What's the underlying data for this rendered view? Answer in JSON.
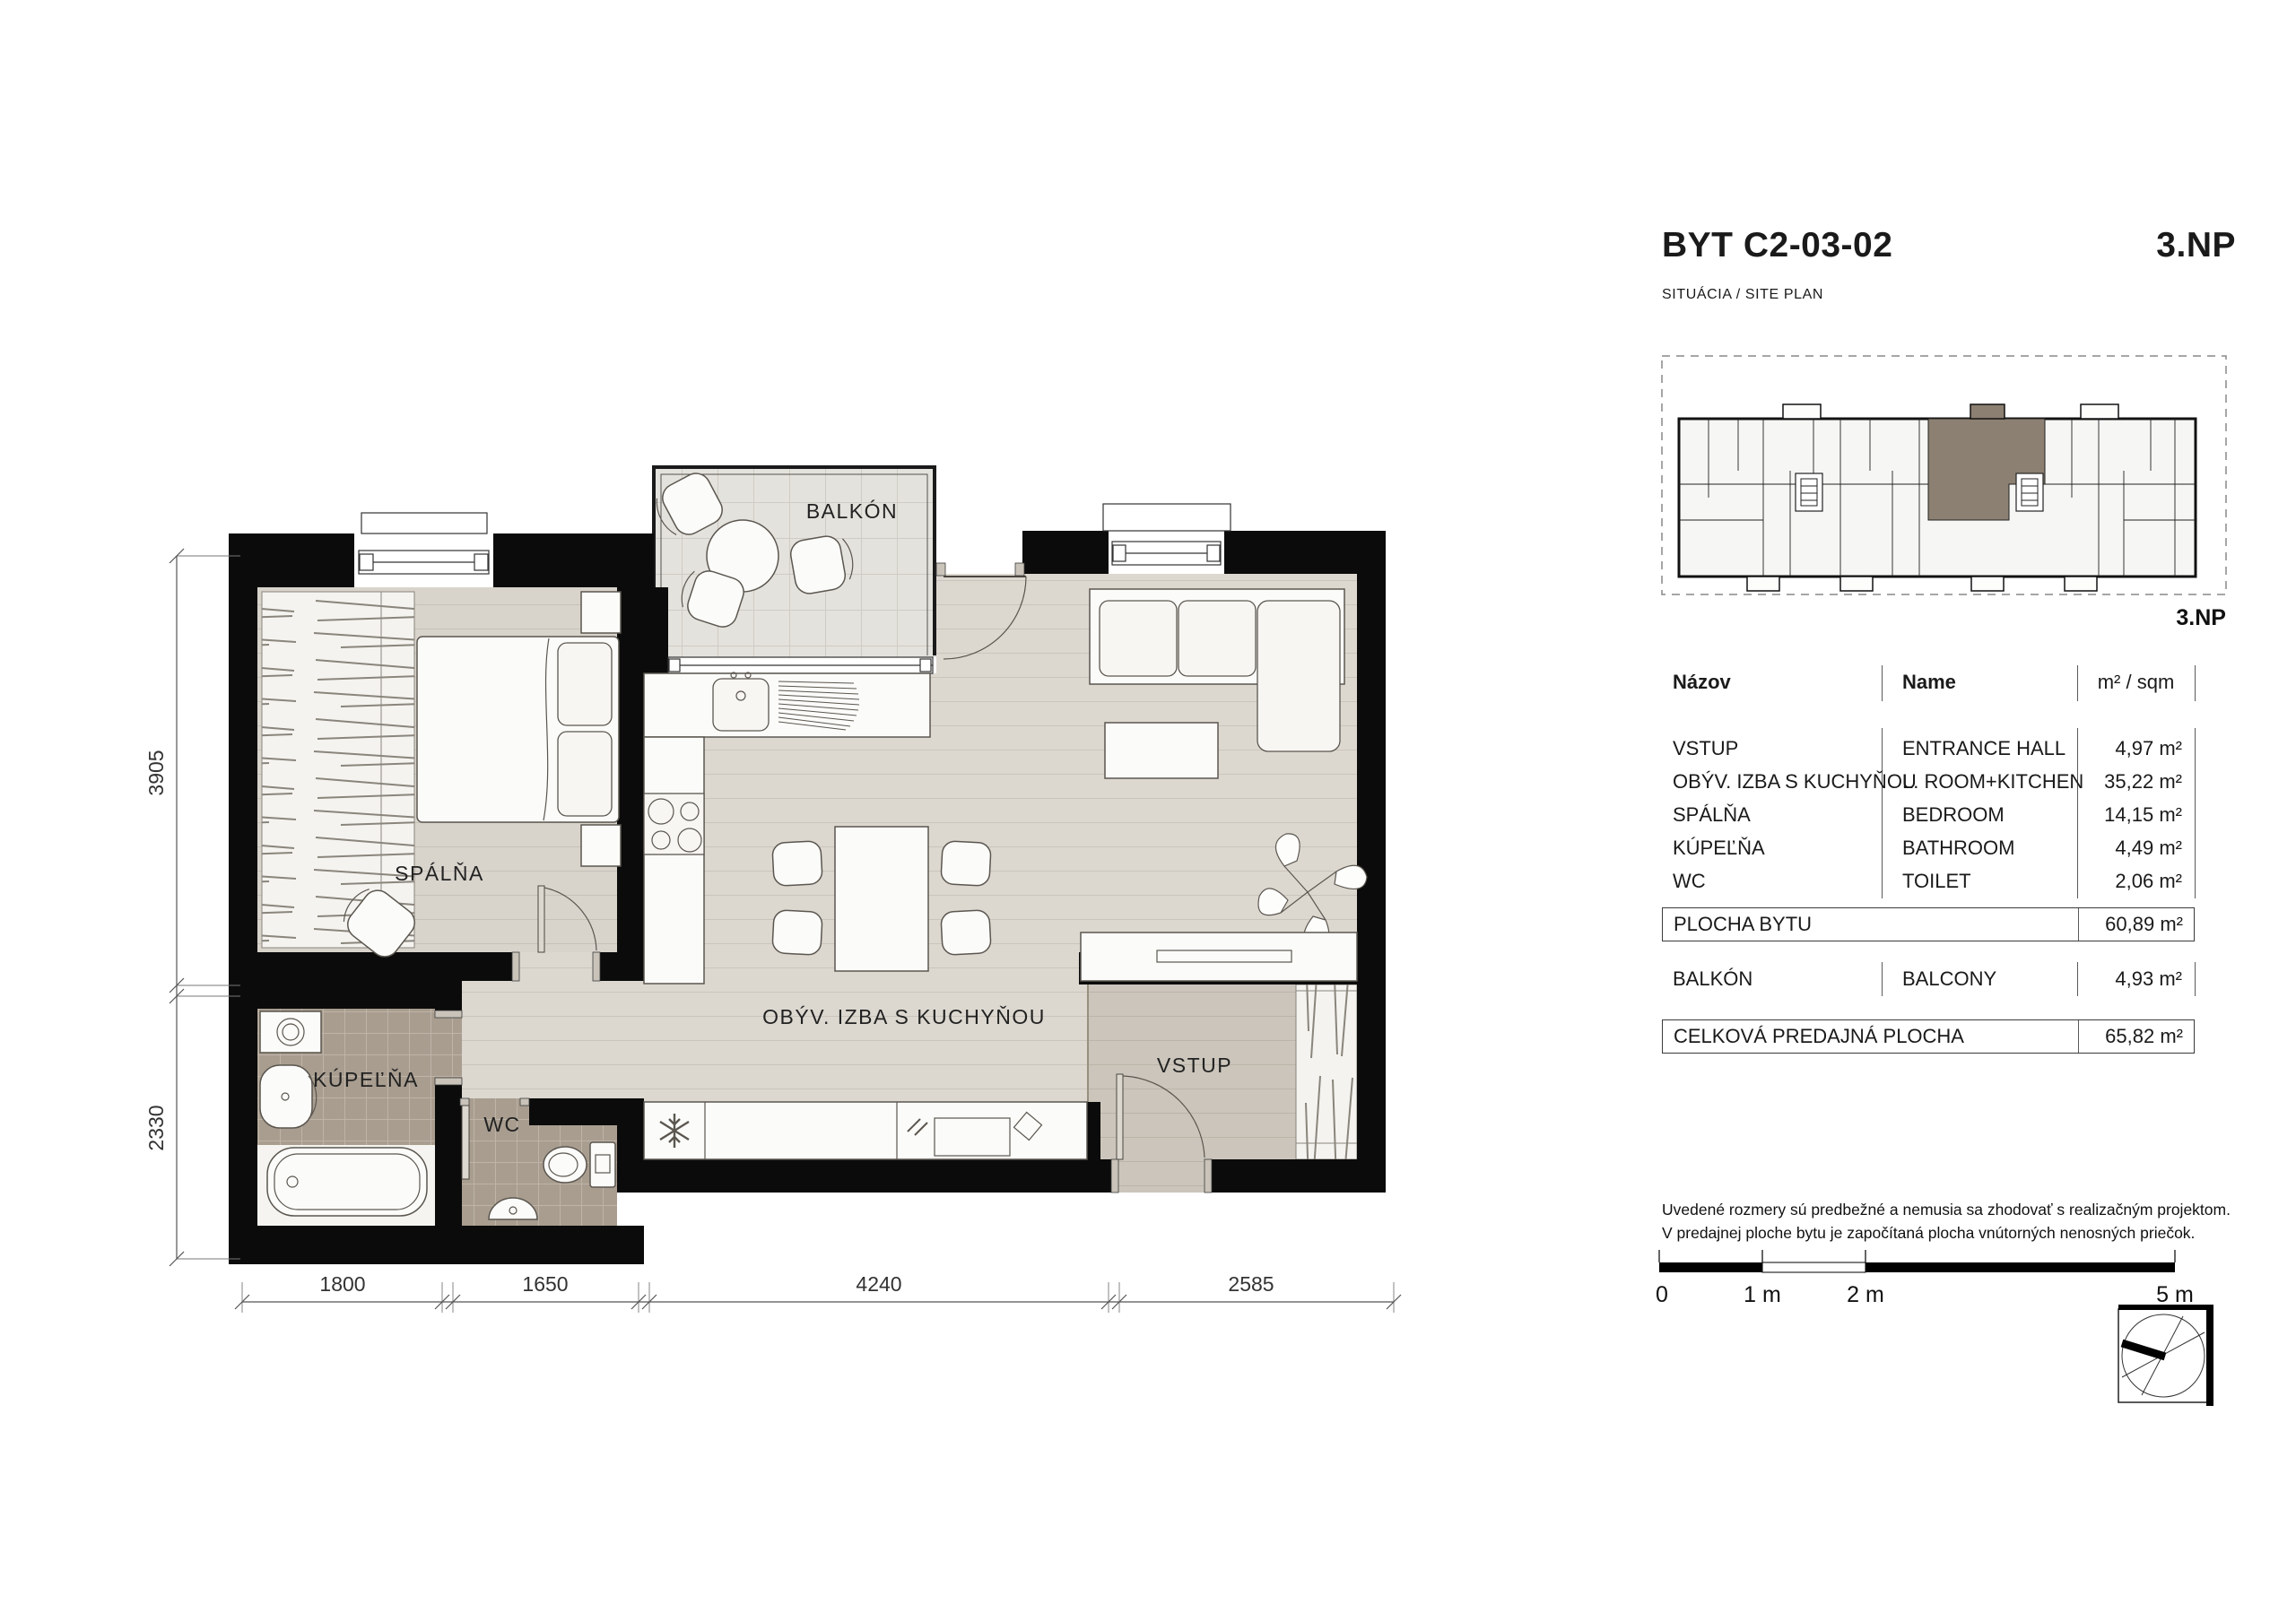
{
  "header": {
    "title": "BYT C2-03-02",
    "floor": "3.NP",
    "subtitle": "SITUÁCIA / SITE PLAN"
  },
  "site_plan": {
    "floor_label": "3.NP",
    "highlight_color": "#8c8072"
  },
  "area_table": {
    "col_nazov": "Názov",
    "col_name": "Name",
    "col_area": "m² / sqm",
    "rows": [
      {
        "nazov": "VSTUP",
        "name": "ENTRANCE HALL",
        "area": "4,97 m²"
      },
      {
        "nazov": "OBÝV. IZBA S KUCHYŇOU",
        "name": "L. ROOM+KITCHEN",
        "area": "35,22 m²"
      },
      {
        "nazov": "SPÁLŇA",
        "name": "BEDROOM",
        "area": "14,15 m²"
      },
      {
        "nazov": "KÚPEĽŇA",
        "name": "BATHROOM",
        "area": "4,49 m²"
      },
      {
        "nazov": "WC",
        "name": "TOILET",
        "area": "2,06 m²"
      }
    ],
    "flat_area": {
      "label": "PLOCHA BYTU",
      "area": "60,89 m²"
    },
    "balcony": {
      "label": "BALKÓN",
      "name": "BALCONY",
      "area": "4,93 m²"
    },
    "total": {
      "label": "CELKOVÁ PREDAJNÁ PLOCHA",
      "area": "65,82 m²"
    }
  },
  "floor_plan": {
    "rooms": {
      "bedroom": "SPÁLŇA",
      "balcony": "BALKÓN",
      "living": "OBÝV. IZBA S KUCHYŇOU",
      "entrance": "VSTUP",
      "bathroom": "KÚPEĽŇA",
      "wc": "WC"
    },
    "dimensions": {
      "left_top": "3905",
      "left_bottom": "2330",
      "bottom_1": "1800",
      "bottom_2": "1650",
      "bottom_3": "4240",
      "bottom_4": "2585"
    }
  },
  "scale_bar": {
    "t0": "0",
    "t1": "1 m",
    "t2": "2 m",
    "t5": "5 m"
  },
  "disclaimer": {
    "line1": "Uvedené rozmery sú predbežné a nemusia sa zhodovať s realizačným projektom.",
    "line2": "V predajnej ploche bytu je započítaná plocha vnútorných nenosných priečok."
  },
  "colors": {
    "wall": "#0b0b0b",
    "floor_living": "#dcd8d0",
    "floor_bedroom": "#d8d4cc",
    "floor_entrance": "#cbc5bb",
    "tile_bath": "#a89d8f",
    "balcony_floor": "#e4e2dc",
    "site_highlight": "#8c8072"
  }
}
